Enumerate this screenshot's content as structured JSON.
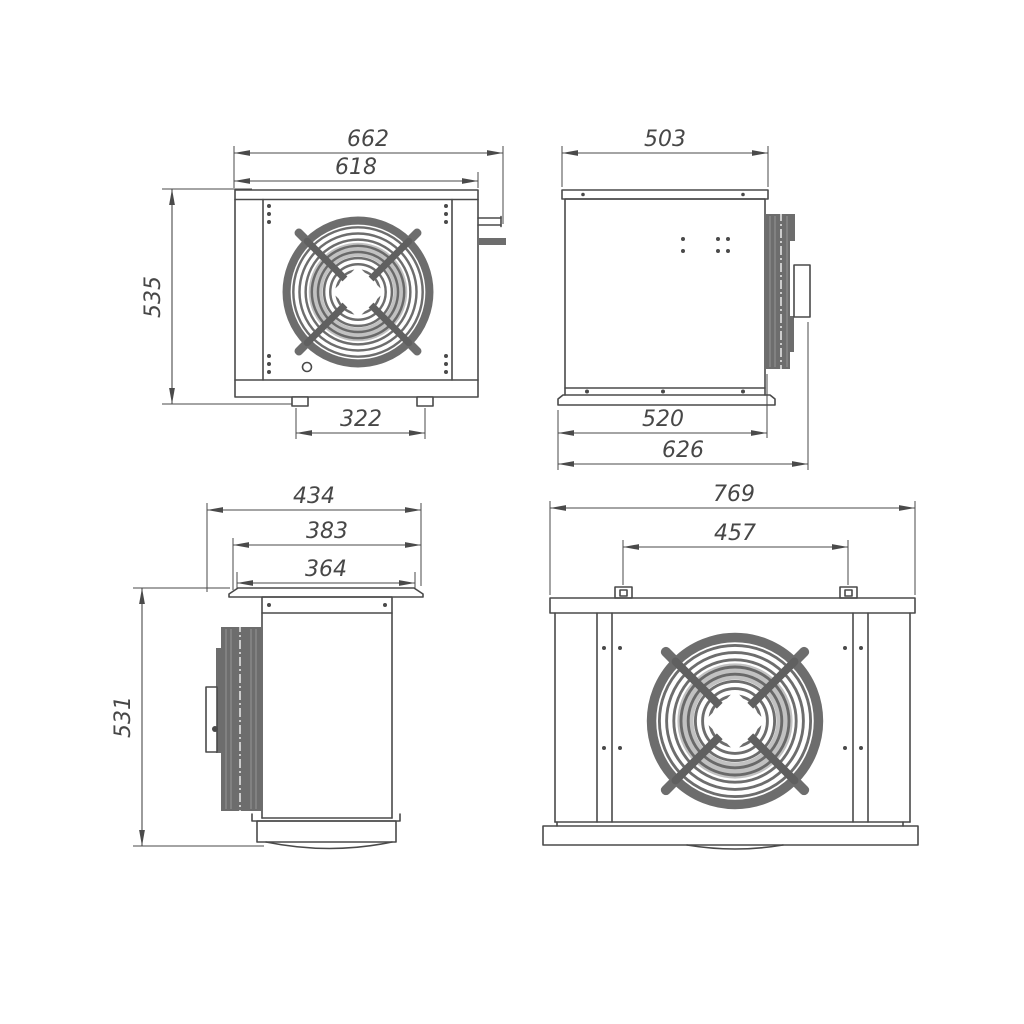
{
  "views": {
    "front": {
      "dims": {
        "overall_width": "662",
        "body_width": "618",
        "height": "535",
        "feet_spacing": "322"
      }
    },
    "side_right": {
      "dims": {
        "top_width": "503",
        "base_width": "520",
        "overall_depth": "626"
      }
    },
    "side_left": {
      "dims": {
        "overall_depth": "434",
        "flange_width": "383",
        "top_plate_width": "364",
        "height": "531"
      }
    },
    "rear": {
      "dims": {
        "overall_width": "769",
        "mount_hole_spacing": "457"
      }
    }
  },
  "colors": {
    "line": "#4a4a4a",
    "metal_grey": "#6d6d6d",
    "background": "#ffffff"
  }
}
